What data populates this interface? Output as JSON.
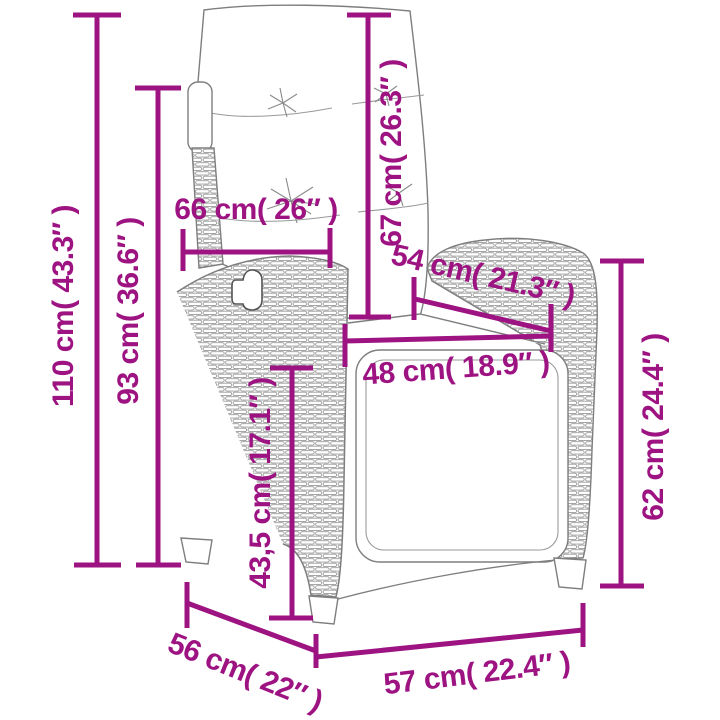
{
  "product_diagram": {
    "accent_color": "#9D1382",
    "line_art_color": "#7E7E7E",
    "measurements": {
      "total_height": {
        "label": "110 cm( 43.3″ )"
      },
      "backrest_height": {
        "label": "93 cm( 36.6″ )"
      },
      "backrest_width": {
        "label": "66 cm( 26″ )"
      },
      "back_cushion_height": {
        "label": "67 cm( 26.3″ )"
      },
      "armrest_depth": {
        "label": "54 cm( 21.3″ )"
      },
      "seat_width": {
        "label": "48 cm( 18.9″ )"
      },
      "seat_height": {
        "label": "43,5 cm( 17.1″ )"
      },
      "armrest_height": {
        "label": "62 cm( 24.4″ )"
      },
      "base_depth": {
        "label": "56 cm( 22″ )"
      },
      "base_width": {
        "label": "57 cm( 22.4″ )"
      }
    }
  }
}
